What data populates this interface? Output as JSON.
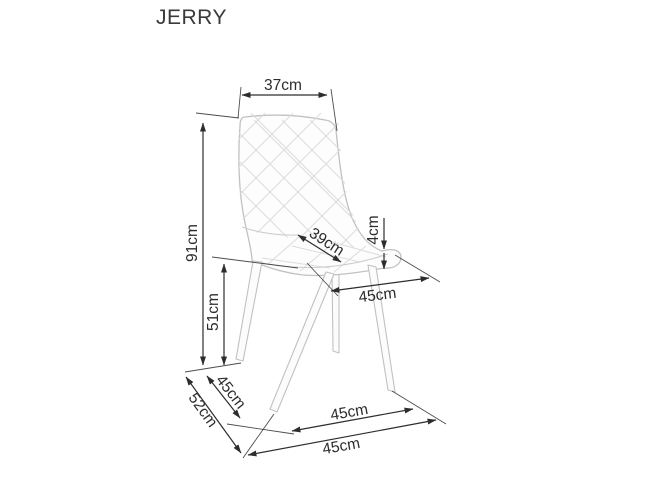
{
  "title": "JERRY",
  "diagram": {
    "type": "product-dimension-diagram",
    "product": "JERRY chair",
    "units": "cm"
  },
  "dims": {
    "backrest_width": "37cm",
    "total_height": "91cm",
    "seat_height": "51cm",
    "seat_depth": "39cm",
    "cushion_thickness": "4cm",
    "seat_width": "45cm",
    "footprint_side_left": "45cm",
    "overall_depth": "52cm",
    "footprint_side_right": "45cm",
    "overall_width": "45cm"
  },
  "colors": {
    "dimension_line": "#2d2d2d",
    "chair_outline": "#c1c1c1",
    "background": "#ffffff",
    "title_text": "#3a3a3a"
  }
}
